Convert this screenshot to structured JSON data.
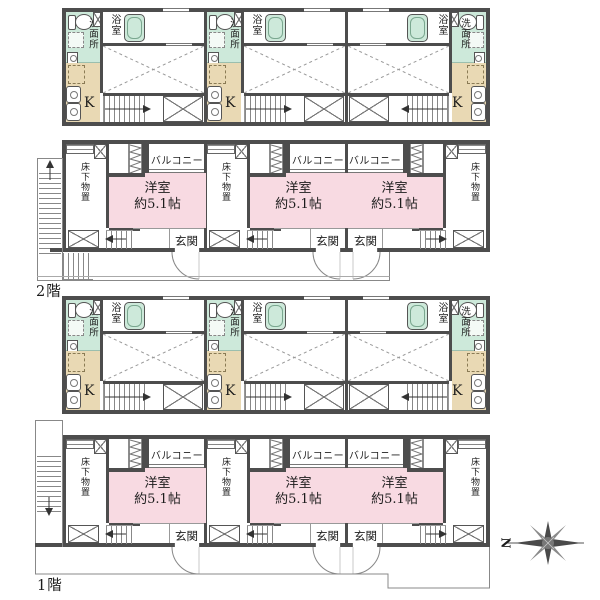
{
  "floors": [
    {
      "label": "2階"
    },
    {
      "label": "1階"
    }
  ],
  "rooms": {
    "bathroom": "浴室",
    "washroom": "洗面所",
    "kitchen": "K",
    "western_room": "洋室",
    "western_room_size": "約5.1帖",
    "balcony": "バルコニー",
    "entrance": "玄関",
    "under_floor_storage": "床下物置"
  },
  "compass": {
    "north": "N"
  },
  "colors": {
    "wall": "#4d4d4d",
    "wet_area_fill": "#cde9da",
    "kitchen_fill": "#e9d9b4",
    "room_fill": "#f8dae2"
  }
}
